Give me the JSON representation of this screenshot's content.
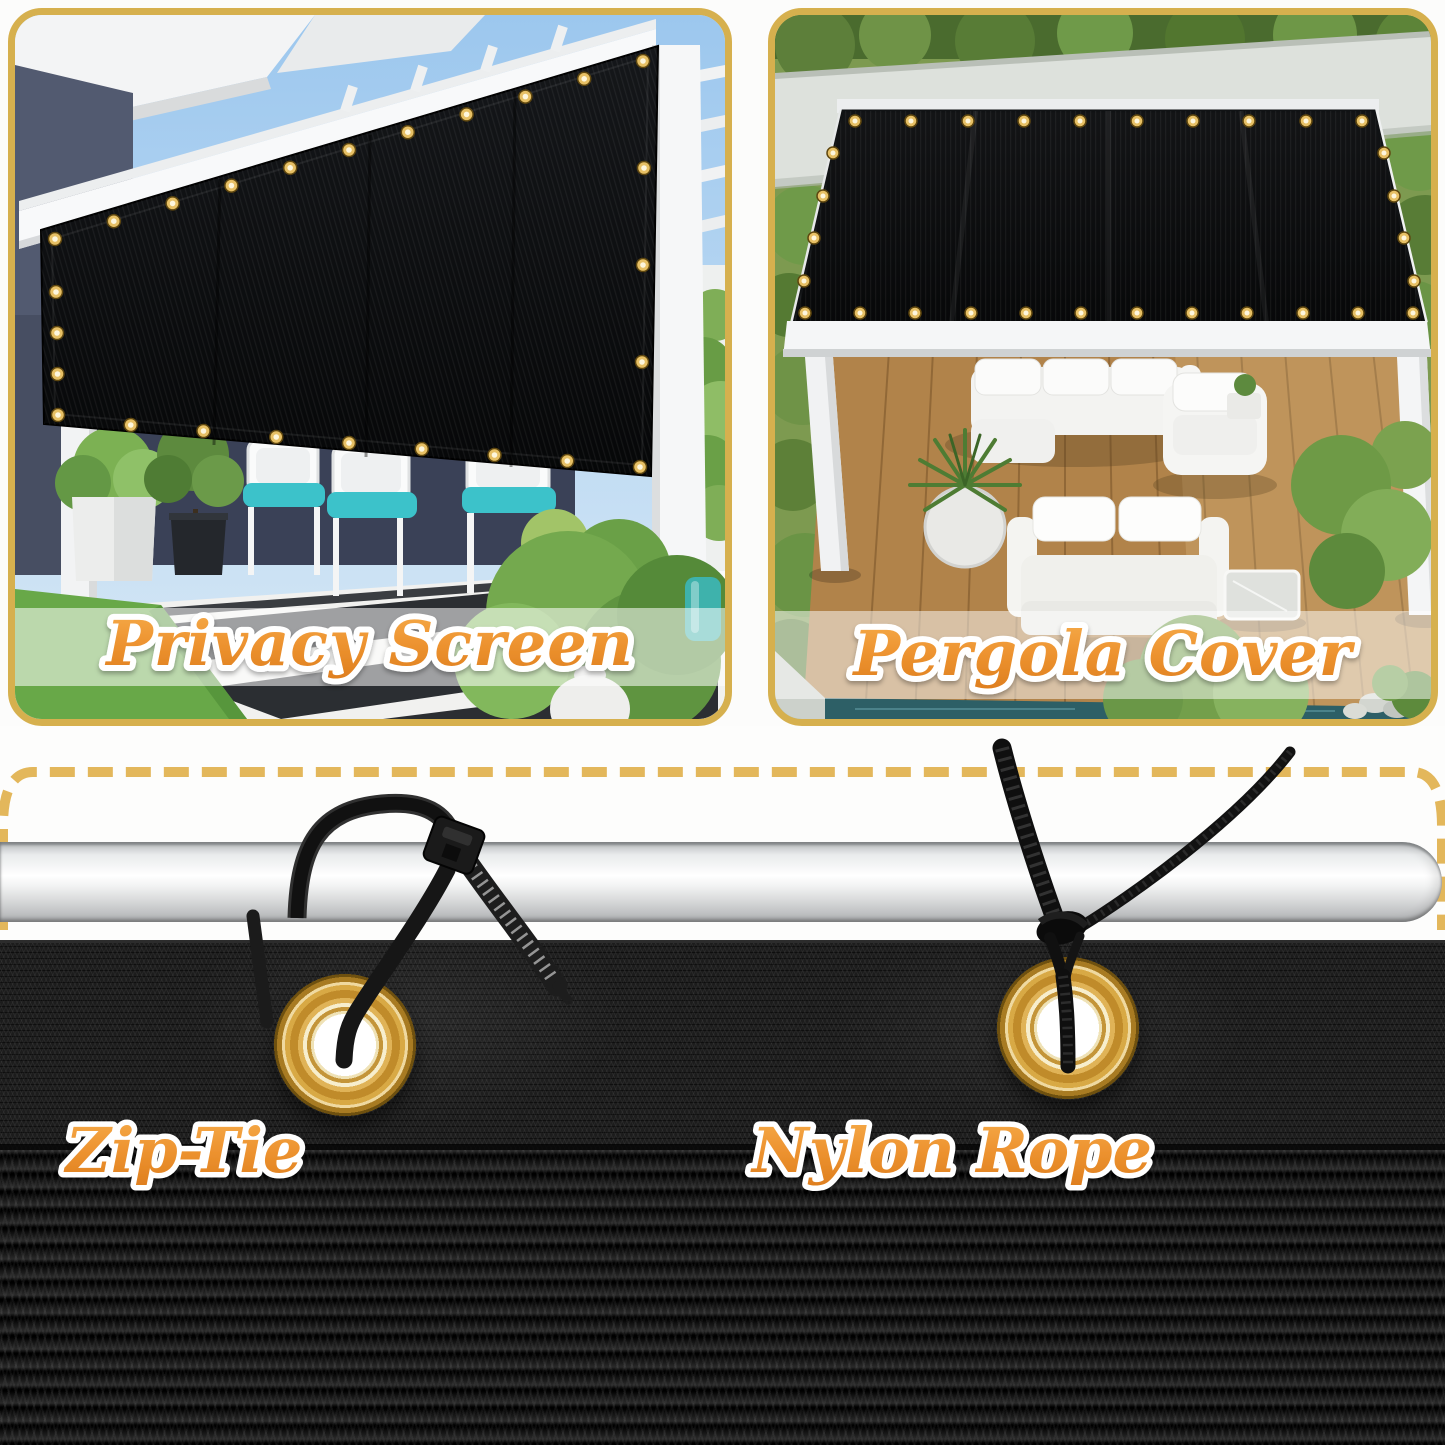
{
  "colors": {
    "background": "#FCFCFB",
    "panel_border_gold": "#D6B04E",
    "panel_border_inner_cream": "#F6ECC6",
    "dashed_line_gold": "#E3B75B",
    "label_orange": "#ED9330",
    "label_outline_white": "#FFFFFF",
    "grommet_brass": "#D8A945",
    "mesh_black": "#1A1A1A",
    "screen_black": "#0B0C0E",
    "cushion_teal": "#3CC2CA",
    "pole_silver": "#E9EBEC"
  },
  "panels": [
    {
      "id": "privacy-screen",
      "label": "Privacy Screen"
    },
    {
      "id": "pergola-cover",
      "label": "Pergola Cover"
    }
  ],
  "installation": {
    "methods": [
      {
        "id": "zip-tie",
        "label": "Zip-Tie"
      },
      {
        "id": "nylon-rope",
        "label": "Nylon Rope"
      }
    ]
  }
}
